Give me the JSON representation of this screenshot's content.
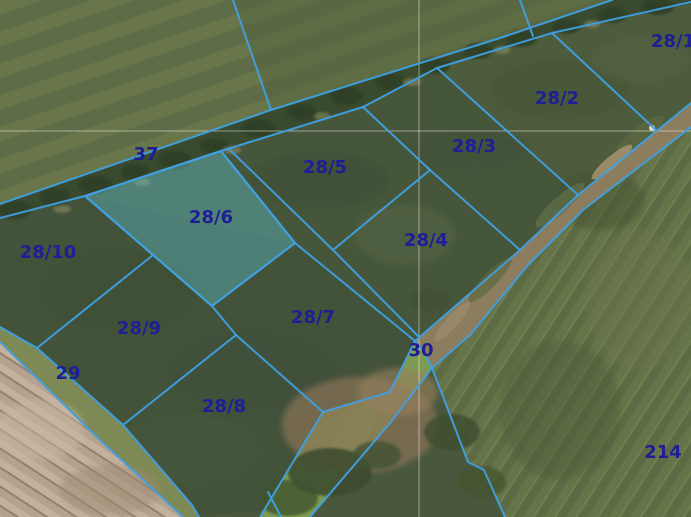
{
  "map": {
    "type": "cadastral-parcel-map-over-aerial-photo",
    "selected_parcel": "28/6",
    "colors": {
      "boundary_line": "#3fa0e4",
      "parcel_label": "#1e1e96",
      "selected_fill": "rgba(96,200,215,0.38)",
      "selected_stroke": "#45b2e8",
      "graticule": "rgba(246,246,238,0.5)"
    },
    "graticule": {
      "vertical_x": 419,
      "horizontal_y": 131
    },
    "parcels": [
      {
        "label": "28/1",
        "x": 673,
        "y": 42,
        "highlighted": false
      },
      {
        "label": "28/2",
        "x": 557,
        "y": 99,
        "highlighted": false
      },
      {
        "label": "28/3",
        "x": 474,
        "y": 147,
        "highlighted": false
      },
      {
        "label": "28/4",
        "x": 426,
        "y": 241,
        "highlighted": false
      },
      {
        "label": "28/5",
        "x": 325,
        "y": 168,
        "highlighted": false
      },
      {
        "label": "28/6",
        "x": 211,
        "y": 218,
        "highlighted": true
      },
      {
        "label": "28/7",
        "x": 313,
        "y": 318,
        "highlighted": false
      },
      {
        "label": "28/8",
        "x": 224,
        "y": 407,
        "highlighted": false
      },
      {
        "label": "28/9",
        "x": 139,
        "y": 329,
        "highlighted": false
      },
      {
        "label": "28/10",
        "x": 48,
        "y": 253,
        "highlighted": false
      },
      {
        "label": "37",
        "x": 146,
        "y": 155,
        "highlighted": false
      },
      {
        "label": "29",
        "x": 68,
        "y": 374,
        "highlighted": false
      },
      {
        "label": "30",
        "x": 421,
        "y": 351,
        "highlighted": false
      },
      {
        "label": "214",
        "x": 663,
        "y": 453,
        "highlighted": false
      }
    ]
  }
}
